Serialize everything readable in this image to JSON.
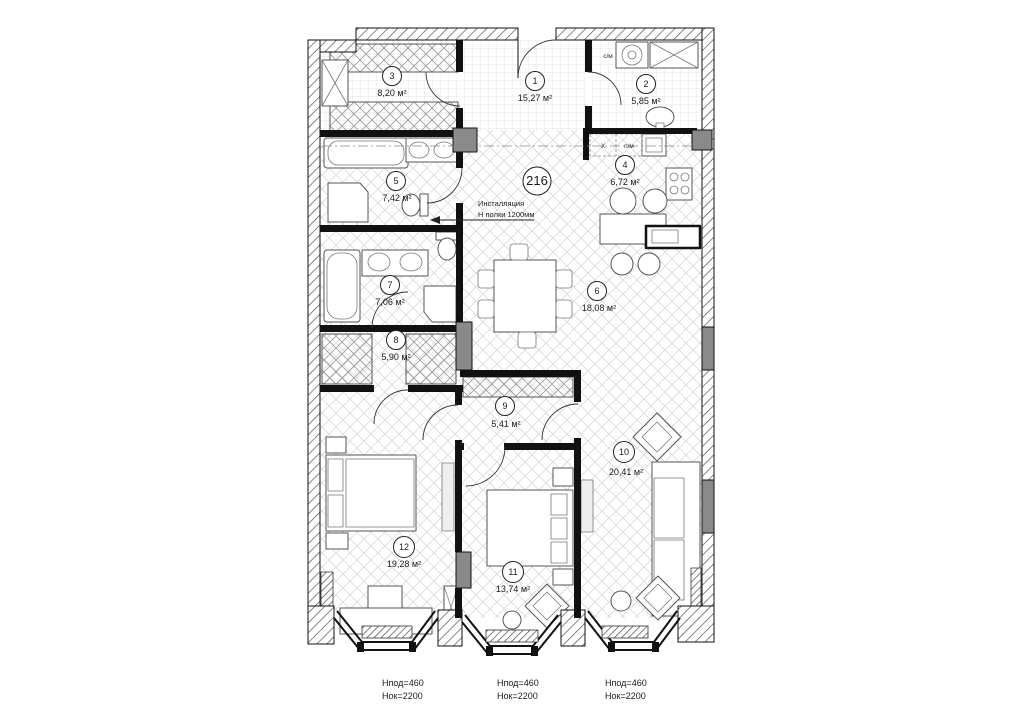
{
  "plan": {
    "apartment_number": "216",
    "installation_note": {
      "line1": "Инсталляция",
      "line2": "Н полки 1200мм"
    },
    "rooms": [
      {
        "num": "1",
        "area": "15,27 м²"
      },
      {
        "num": "2",
        "area": "5,85 м²"
      },
      {
        "num": "3",
        "area": "8,20 м²"
      },
      {
        "num": "4",
        "area": "6,72 м²"
      },
      {
        "num": "5",
        "area": "7,42 м²"
      },
      {
        "num": "6",
        "area": "18,08 м²"
      },
      {
        "num": "7",
        "area": "7,06 м²"
      },
      {
        "num": "8",
        "area": "5,90 м²"
      },
      {
        "num": "9",
        "area": "5,41 м²"
      },
      {
        "num": "10",
        "area": "20,41 м²"
      },
      {
        "num": "11",
        "area": "13,74 м²"
      },
      {
        "num": "12",
        "area": "19,28 м²"
      }
    ],
    "appliances": {
      "washer": "с/м",
      "fridge": "Х",
      "dishwasher": "п/м"
    },
    "window_notes": [
      {
        "line1": "Нпод=460",
        "line2": "Нок=2200"
      },
      {
        "line1": "Нпод=460",
        "line2": "Нок=2200"
      },
      {
        "line1": "Нпод=460",
        "line2": "Нок=2200"
      }
    ],
    "colors": {
      "wall": "#111111",
      "shaft": "#8a8a8a",
      "floor_line": "#d3d3d3"
    }
  }
}
